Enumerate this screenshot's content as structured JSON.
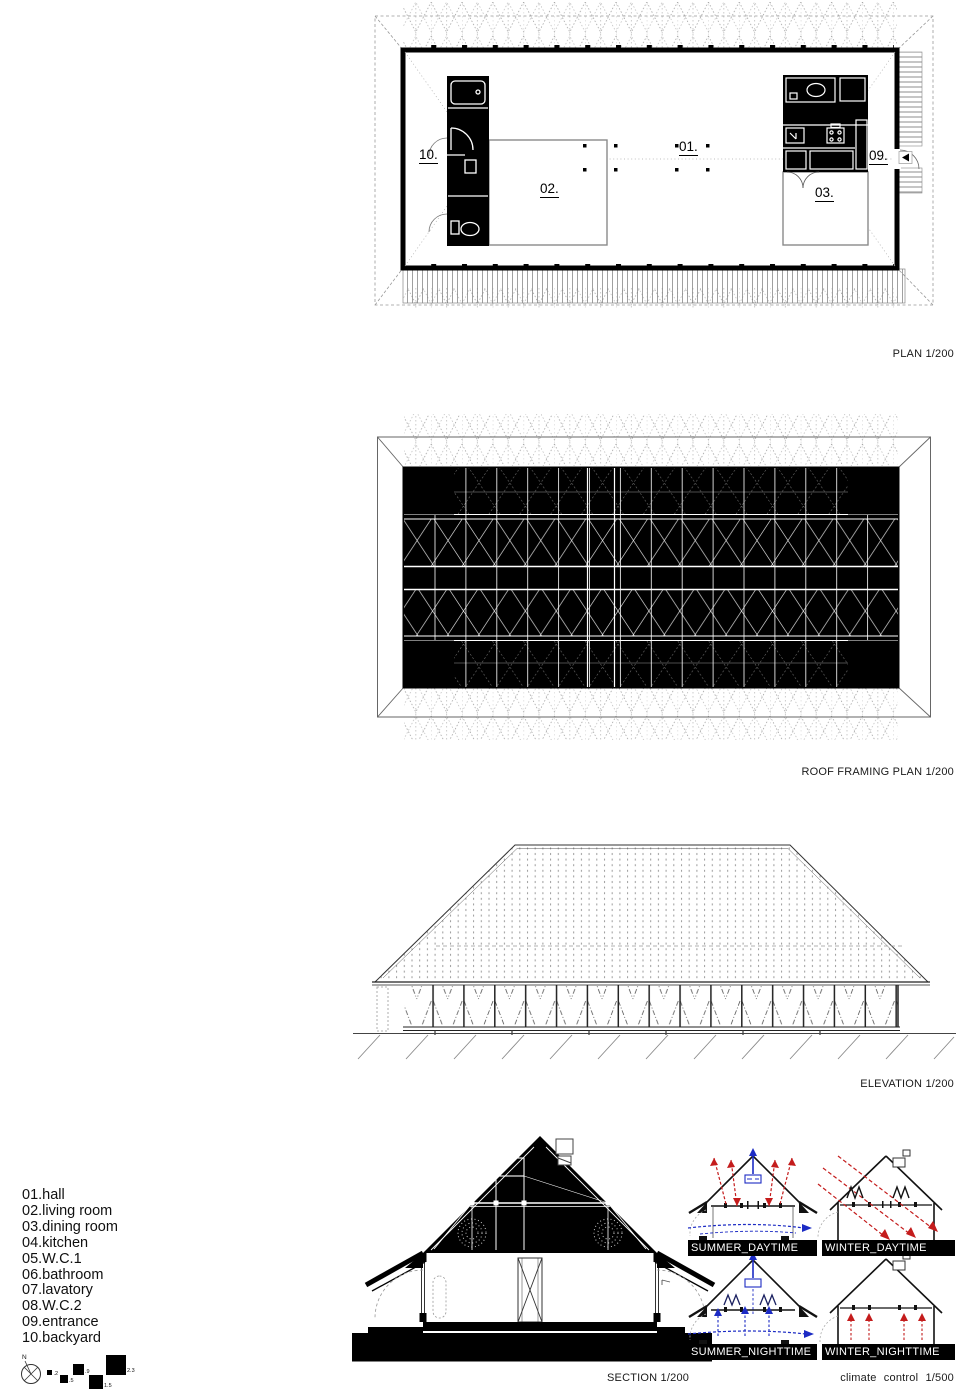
{
  "titles": {
    "plan": "PLAN 1/200",
    "roof": "ROOF FRAMING PLAN 1/200",
    "elevation": "ELEVATION 1/200",
    "section": "SECTION 1/200",
    "climate": "climate control  1/500"
  },
  "plan": {
    "room_labels": [
      {
        "id": "10",
        "label": "10."
      },
      {
        "id": "02",
        "label": "02."
      },
      {
        "id": "01",
        "label": "01."
      },
      {
        "id": "03",
        "label": "03."
      },
      {
        "id": "09",
        "label": "09."
      }
    ]
  },
  "legend": {
    "items": [
      "01.hall",
      "02.living room",
      "03.dining room",
      "04.kitchen",
      "05.W.C.1",
      "06.bathroom",
      "07.lavatory",
      "08.W.C.2",
      "09.entrance",
      "10.backyard"
    ]
  },
  "climate": {
    "diagrams": [
      {
        "label": "SUMMER_DAYTIME"
      },
      {
        "label": "WINTER_DAYTIME"
      },
      {
        "label": "SUMMER_NIGHTTIME"
      },
      {
        "label": "WINTER_NIGHTTIME"
      }
    ]
  },
  "compass": {
    "north": "N"
  },
  "scale_bar": {
    "values": [
      ".2",
      ".5",
      ".9",
      "1.5",
      "2.3"
    ]
  },
  "colors": {
    "warm_air": "#c41x1c",
    "cool_air": "#1c2bc4",
    "ink": "#000000",
    "warm": "#c41c1c"
  }
}
